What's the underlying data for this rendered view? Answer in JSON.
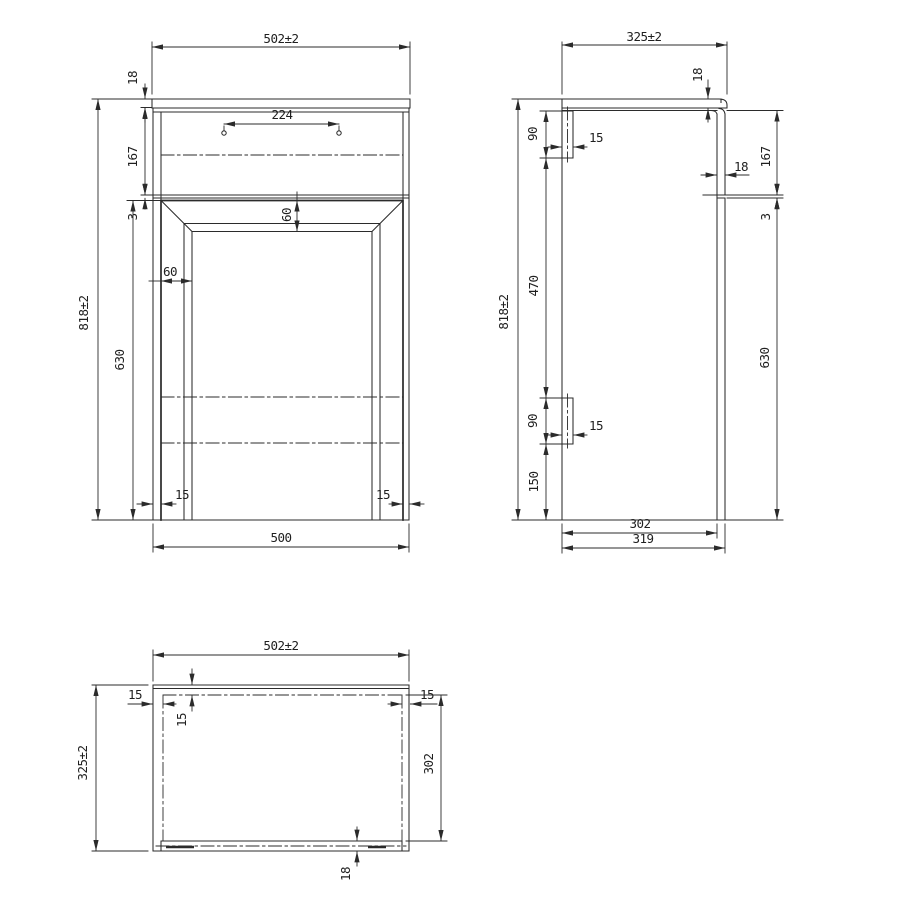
{
  "drawing": {
    "type": "technical-dimension-drawing",
    "background_color": "#ffffff",
    "line_color": "#2b2b2b",
    "views": [
      "front",
      "side",
      "plan"
    ]
  },
  "front": {
    "width_top": "502±2",
    "hole_spacing": "224",
    "counter_thickness": "18",
    "upper_panel_height": "167",
    "gap": "3",
    "overall_height": "818±2",
    "door_height": "630",
    "frame_top_width": "60",
    "frame_side_width": "60",
    "side_reveal_left": "15",
    "side_reveal_right": "15",
    "body_width": "500"
  },
  "side": {
    "depth_top": "325±2",
    "counter_thickness": "18",
    "hanger_top_height": "90",
    "hanger_top_depth": "15",
    "upper_panel_height": "167",
    "door_thickness": "18",
    "gap": "3",
    "overall_height": "818±2",
    "hanger_spacing": "470",
    "hanger_bottom_height": "90",
    "hanger_bottom_depth": "15",
    "hanger_bottom_offset": "150",
    "door_height": "630",
    "inner_depth": "302",
    "body_depth": "319"
  },
  "plan": {
    "width_top": "502±2",
    "depth": "325±2",
    "panel_left": "15",
    "panel_back": "15",
    "panel_right": "15",
    "inner_depth": "302",
    "door_thickness": "18"
  }
}
